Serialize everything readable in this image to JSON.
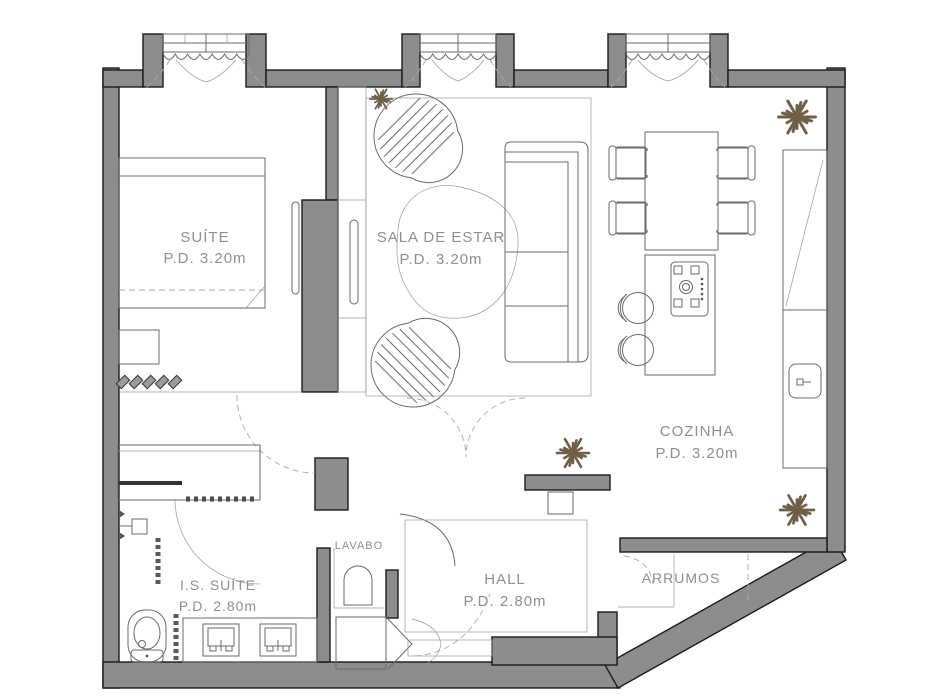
{
  "colors": {
    "wall_fill": "#8d8d8d",
    "wall_stroke": "#1b1b1b",
    "line_color": "#6a6a6a",
    "label_color": "#8f8f8f",
    "plant_color": "#6f5f48"
  },
  "rooms": {
    "suite": {
      "name": "SUÍTE",
      "pd": "P.D. 3.20m"
    },
    "sala": {
      "name": "SALA DE ESTAR",
      "pd": "P.D. 3.20m"
    },
    "cozinha": {
      "name": "COZINHA",
      "pd": "P.D. 3.20m"
    },
    "is_suite": {
      "name": "I.S. SUÍTE",
      "pd": "P.D. 2.80m"
    },
    "lavabo": {
      "name": "LAVABO"
    },
    "hall": {
      "name": "HALL",
      "pd": "P.D. 2.80m"
    },
    "arrumos": {
      "name": "ARRUMOS"
    }
  },
  "icons": [
    "plant-icon",
    "bed-icon",
    "bench-icon",
    "tv-panel-icon",
    "wardrobe-icon",
    "armchair-icon",
    "sofa-icon",
    "rug-icon",
    "dining-table-icon",
    "chair-icon",
    "kitchen-island-icon",
    "cooktop-icon",
    "stool-icon",
    "counter-icon",
    "kitchen-sink-icon",
    "window-curtain-icon",
    "door-swing-icon",
    "shower-icon",
    "towel-rail-icon",
    "toilet-icon",
    "vanity-sink-icon",
    "washbasin-icon",
    "closet-bifold-icon",
    "console-icon",
    "slippers-icon"
  ]
}
